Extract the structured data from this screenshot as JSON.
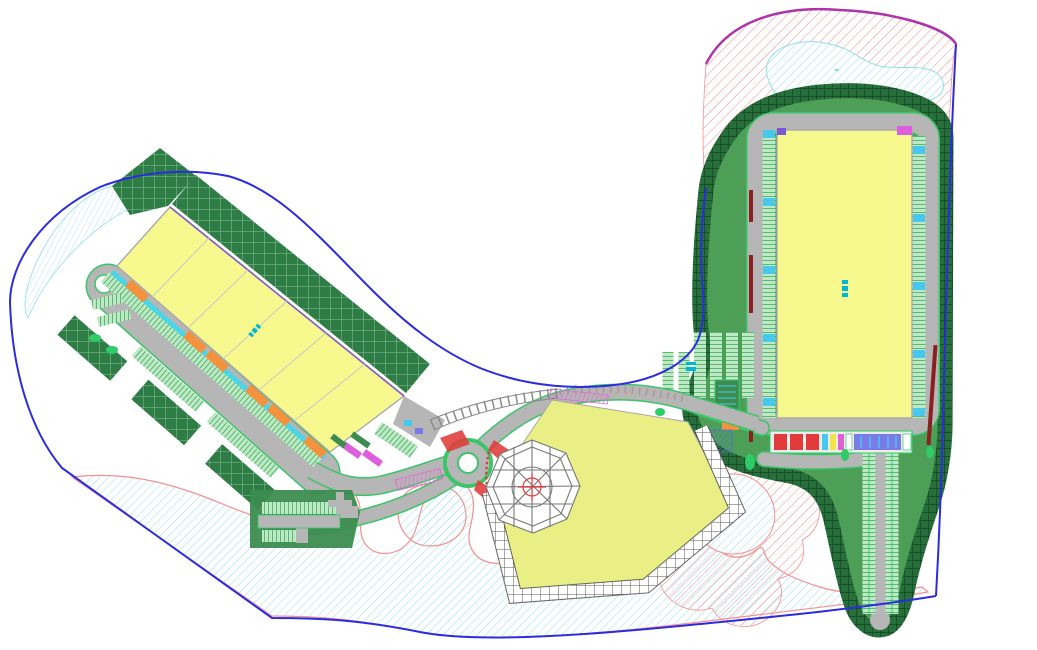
{
  "drawing": {
    "title": "site-master-plan",
    "canvas": {
      "width": 1037,
      "height": 650
    },
    "labels": {
      "pond_mark": "≈",
      "entrance_mark": "≈"
    },
    "areas": [
      {
        "id": "left-warehouse",
        "type": "building"
      },
      {
        "id": "right-warehouse",
        "type": "building"
      },
      {
        "id": "event-lawn-pentagon",
        "type": "landscape"
      },
      {
        "id": "octagon-pavilion",
        "type": "structure"
      },
      {
        "id": "roundabout",
        "type": "road"
      },
      {
        "id": "overflow-parking",
        "type": "parking"
      },
      {
        "id": "wetland-band",
        "type": "water"
      },
      {
        "id": "north-pond",
        "type": "water"
      },
      {
        "id": "reserve-zone-red-hatch",
        "type": "reserve"
      }
    ]
  },
  "colors": {
    "paper": "#ffffff",
    "buildingFill": "#f7f98e",
    "buildingEdge": "#a9a9a9",
    "buildingDivider": "#c9c9c9",
    "purpleEdge": "#7a5ad0",
    "pentagonFill": "#e9ef85",
    "roadGray": "#b6b6b6",
    "roadEdgeGreen": "#3cc469",
    "lawnGreen": "#4d9e57",
    "lawnDeep": "#3c8c50",
    "bermBase": "#276f3a",
    "bermLine": "#123a1f",
    "fieldBase": "#2f7d46",
    "fieldLine": "#9fd3a8",
    "stallBase": "#bfe8c4",
    "stallLine": "#1fa04a",
    "brightGreen": "#2ecc66",
    "boundaryBlue": "#2b2be0",
    "boundaryPurple": "#9b30d0",
    "redHatch": "#f08a8a",
    "pondLine": "#8fdeec",
    "pondEdge": "#f49090",
    "cyanApron": "#49d6e8",
    "dockOrange": "#f5923e",
    "magenta": "#de5fde",
    "labelCyan": "#00b8d4",
    "curbRed": "#e23b3b",
    "darkRed": "#8c1f1f",
    "bayBlue": "#7b7be8",
    "bayYellow": "#f2e34a",
    "bayCyan": "#49c8ee",
    "bayMagenta": "#e25fd2",
    "solarBlue": "#5a6ae0",
    "wire": "#777777",
    "terrLine": "#555555",
    "crossPink": "#e866d8"
  }
}
